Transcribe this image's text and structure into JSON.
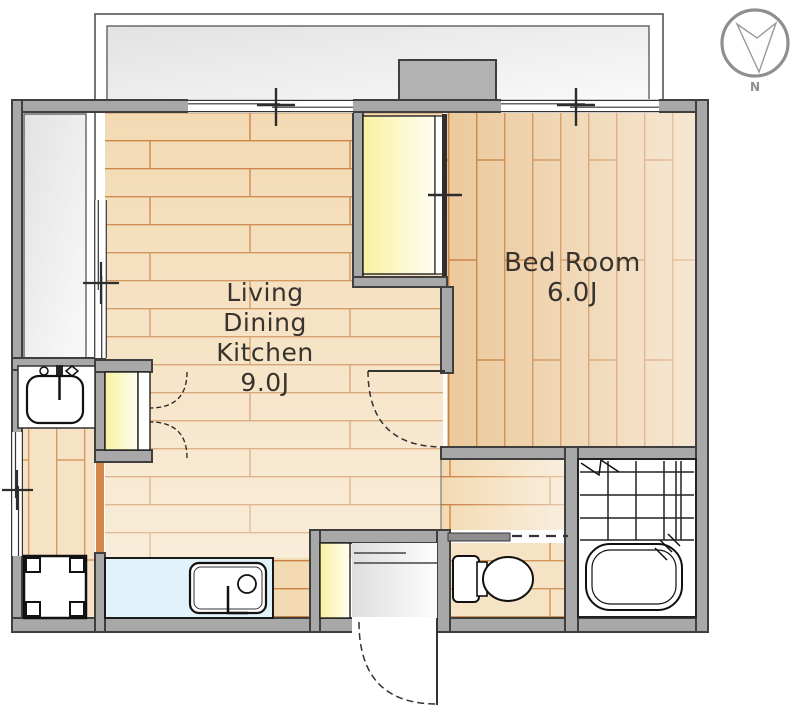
{
  "rooms": {
    "ldk": {
      "lines": [
        "Living",
        "Dining",
        "Kitchen",
        "9.0J"
      ]
    },
    "bedroom": {
      "lines": [
        "Bed Room",
        "6.0J"
      ]
    }
  },
  "compass": {
    "north_label": "N"
  },
  "colors": {
    "wall": "#a8a8a8",
    "wall_outline": "#3f3f3f",
    "pillar": "#b2b2b2",
    "floor_ldk": "#f3dab3",
    "floor_bedroom": "#ebc99b",
    "floor_light": "#f6e3c6",
    "plank_line": "#c9813f",
    "closet_yellow": "#f8f1a0",
    "counter_blue": "#e2f2fa",
    "balcony_gray": "#e7e7e7",
    "text": "#39332e",
    "compass_gray": "#8f8f8f"
  }
}
